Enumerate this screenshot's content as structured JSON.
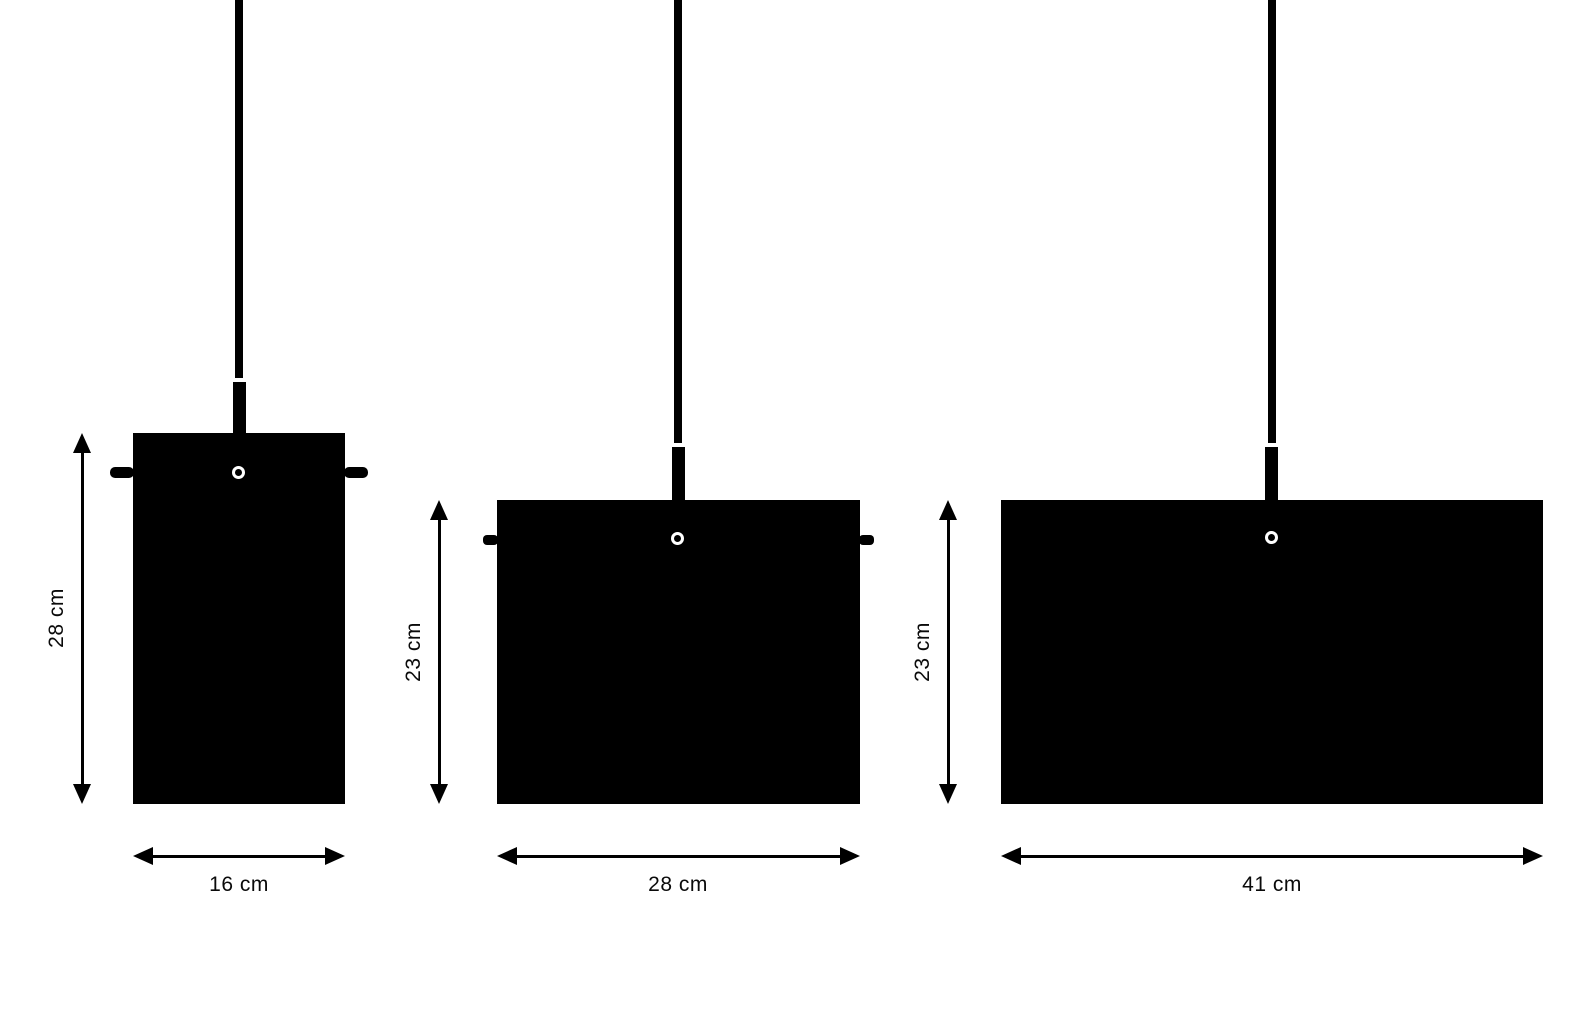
{
  "diagram": {
    "type": "product-dimension-diagram",
    "subject": "three pendant lamp shades with suspension cords and measurement arrows",
    "unit": "cm",
    "colors": {
      "ink": "#000000",
      "background": "#ffffff",
      "eyelet_ring": "#ffffff"
    },
    "lamps": [
      {
        "name": "small-pendant",
        "width_cm": 16,
        "height_cm": 28,
        "width_label": "16 cm",
        "height_label": "28 cm",
        "has_side_pins": true
      },
      {
        "name": "medium-pendant",
        "width_cm": 28,
        "height_cm": 23,
        "width_label": "28 cm",
        "height_label": "23 cm",
        "has_side_pins": true
      },
      {
        "name": "large-pendant",
        "width_cm": 41,
        "height_cm": 23,
        "width_label": "41 cm",
        "height_label": "23 cm",
        "has_side_pins": false
      }
    ]
  }
}
